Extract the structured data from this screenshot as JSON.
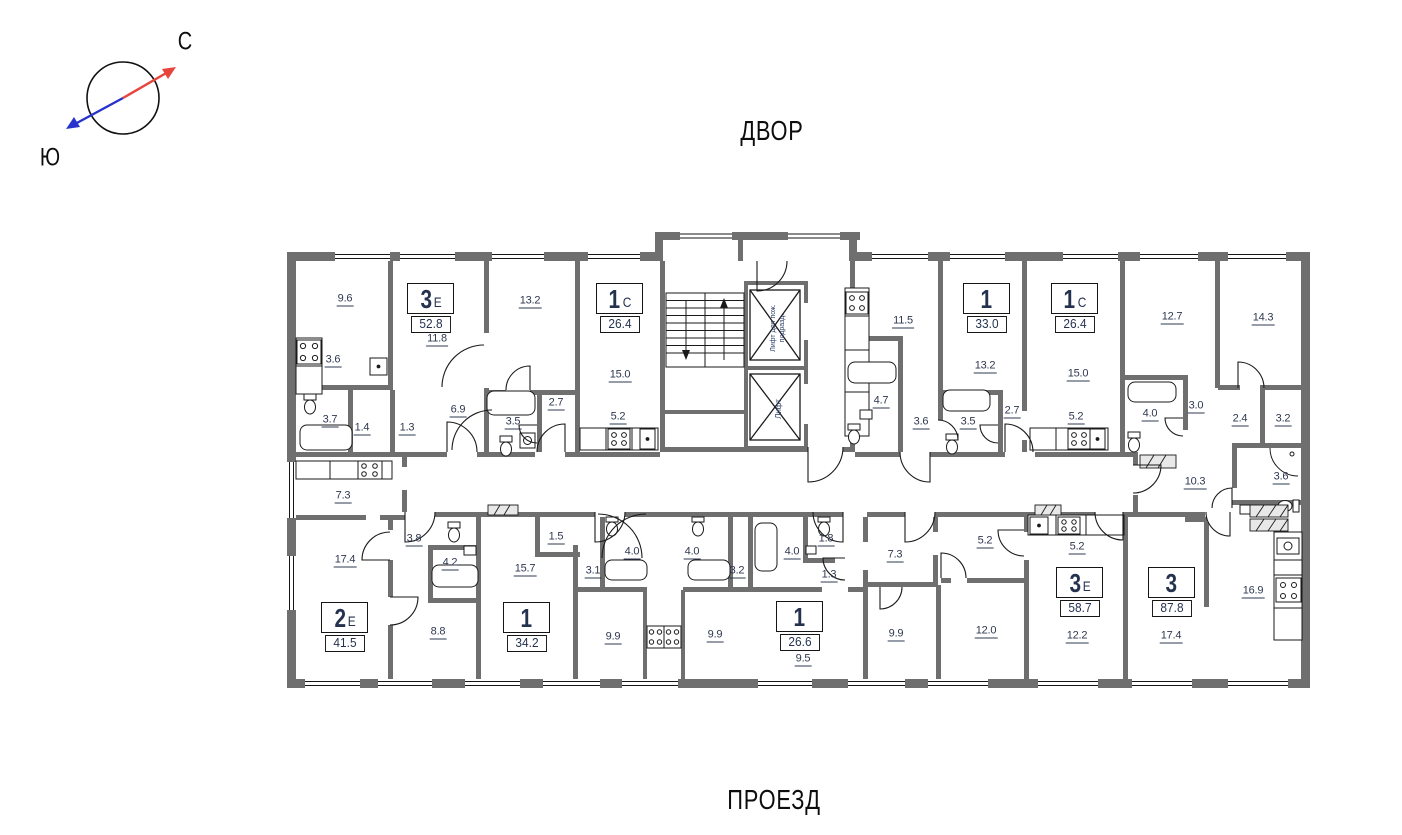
{
  "compass": {
    "north": "С",
    "south": "Ю"
  },
  "surroundings": {
    "top": "ДВОР",
    "bottom": "ПРОЕЗД"
  },
  "core": {
    "fire_elevator": "Лифт для пож. подразд.",
    "elevator": "Лифт"
  },
  "apartments": [
    {
      "type": "3",
      "suffix": "Е",
      "area": "52.8"
    },
    {
      "type": "1",
      "suffix": "С",
      "area": "26.4"
    },
    {
      "type": "1",
      "suffix": "",
      "area": "33.0"
    },
    {
      "type": "1",
      "suffix": "С",
      "area": "26.4"
    },
    {
      "type": "2",
      "suffix": "Е",
      "area": "41.5"
    },
    {
      "type": "1",
      "suffix": "",
      "area": "34.2"
    },
    {
      "type": "1",
      "suffix": "",
      "area": "26.6"
    },
    {
      "type": "3",
      "suffix": "Е",
      "area": "58.7"
    },
    {
      "type": "3",
      "suffix": "",
      "area": "87.8"
    }
  ],
  "room_areas": [
    "9.6",
    "3.6",
    "3.7",
    "1.4",
    "1.3",
    "11.8",
    "6.9",
    "13.2",
    "3.5",
    "2.7",
    "15.0",
    "5.2",
    "11.5",
    "4.7",
    "3.6",
    "13.2",
    "3.5",
    "2.7",
    "15.0",
    "5.2",
    "12.7",
    "4.0",
    "3.0",
    "14.3",
    "2.4",
    "3.2",
    "10.3",
    "3.6",
    "7.3",
    "17.4",
    "3.8",
    "4.2",
    "8.8",
    "1.5",
    "15.7",
    "3.1",
    "4.0",
    "9.9",
    "4.0",
    "3.2",
    "9.9",
    "4.0",
    "1.8",
    "1.3",
    "9.5",
    "7.3",
    "5.2",
    "9.9",
    "12.0",
    "5.2",
    "12.2",
    "17.4",
    "16.9"
  ],
  "colors": {
    "wall": "#6f6f6f",
    "line": "#1a1a1a",
    "label_text": "#2e3850",
    "north_arrow": "#e8443c",
    "south_arrow": "#2733cc"
  }
}
